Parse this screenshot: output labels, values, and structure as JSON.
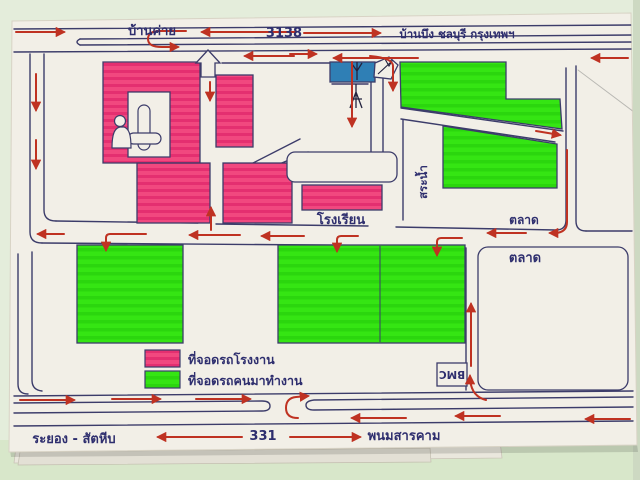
{
  "map": {
    "top_highway": {
      "left_label": "บ้านค่าย",
      "route": "3138",
      "right_label": "บ้านบึง ชลบุรี กรุงเทพฯ"
    },
    "bottom_highway": {
      "left_label": "ระยอง - สัตหีบ",
      "route": "331",
      "right_label": "พนมสารคาม"
    },
    "places": {
      "school": "โรงเรียน",
      "pond": "สระน้ำ",
      "market_upper": "ตลาด",
      "market_lower": "ตลาด",
      "bmc": "BMC"
    },
    "legend": {
      "factory_parking": "ที่จอดรถโรงงาน",
      "worker_parking": "ที่จอดรถคนมาทำงาน"
    },
    "colors": {
      "factory_pink": "#f1437f",
      "parking_green": "#35e513",
      "building_blue": "#2f7fb5",
      "road_ink": "#3c3c6a",
      "arrow_red": "#bf3222",
      "paper": "#f2efe7"
    }
  }
}
